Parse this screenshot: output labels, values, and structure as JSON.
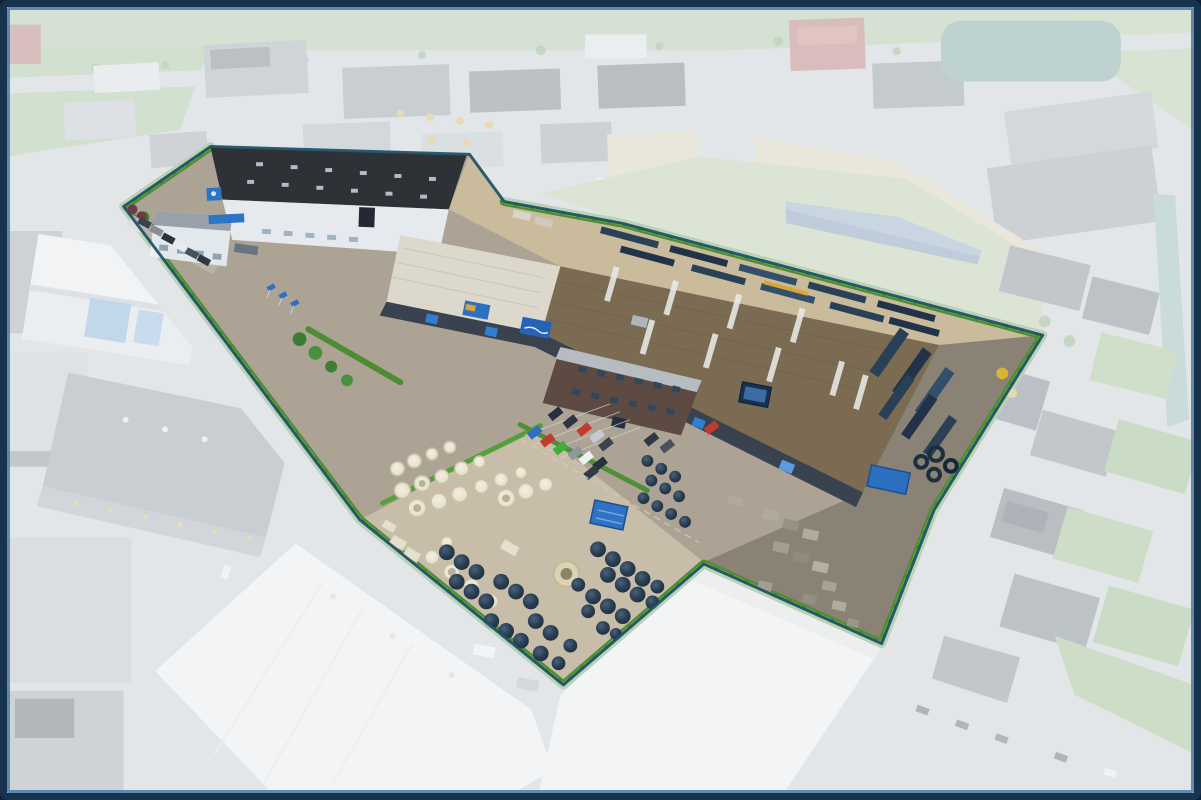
{
  "image": {
    "kind": "aerial-drone-photograph",
    "subject": "industrial company premises highlighted in full color against faded surroundings",
    "width_px": 1201,
    "height_px": 800
  },
  "frame": {
    "outer_color": "#17334e",
    "accent_color": "#4a7aa3",
    "outer_width_px": 7,
    "accent_width_px": 3,
    "corner_radius_px": 8
  },
  "highlight": {
    "fade_overlay_color": "#f2f5f8",
    "fade_overlay_opacity": 0.66,
    "boundary_line_color": "#1d5066",
    "boundary_hedge_color": "#4e8c33",
    "boundary_hedge_accent": "#63a93e"
  },
  "palette": {
    "road": "#c7cbce",
    "asphalt": "#aca394",
    "yard_concrete": "#c8bda8",
    "dark_asphalt": "#8a8375",
    "north_pipes_ground": "#c9bb9c",
    "grass": "#9fbe8c",
    "hedge_green": "#4e8c33",
    "skylight": "#e9ebe8",
    "door_blue": "#2f7fd0",
    "sign_blue": "#2e74c4",
    "container_blue": "#2b6fc0",
    "concrete_product": "#ece7d6",
    "tank_navy": "#253748",
    "pipe_navy": "#2a4056",
    "car_red": "#c23b2f",
    "car_blue": "#2f6fc3",
    "car_green": "#3fae3a",
    "car_white": "#eef0f2",
    "car_dark": "#27313d",
    "car_gray": "#8f979e",
    "faded_building_white": "#f3f3f1",
    "faded_roof_dark": "#565d66",
    "faded_roof_red": "#aa544a",
    "faded_roof_teal": "#5d8f8b",
    "faded_roof_blue": "#5d7fa6",
    "water_teal": "#7fae9e",
    "sand": "#d9c9a4"
  },
  "scene": {
    "property": {
      "buildings": [
        {
          "name": "north-warehouse",
          "roof_color": "#2e3237",
          "wall_color": "#e6eaee",
          "signage": [
            "blue-roof-sign",
            "blue-wall-logo"
          ]
        },
        {
          "name": "main-warehouse",
          "roof_color": "#7b6b53",
          "west_hall_roof_color": "#dcd8cb",
          "facade_color": "#39424e",
          "signage": [
            "facade-banners",
            "billboard-screen"
          ]
        },
        {
          "name": "office-building",
          "brick_color": "#5d4a42",
          "roof_color": "#b7bcc1"
        }
      ],
      "storage": [
        {
          "name": "concrete-products-yard",
          "item_color": "#ece7d6"
        },
        {
          "name": "plastic-tank-yard",
          "item_color": "#253748"
        },
        {
          "name": "pipe-storage-north",
          "item_color": "#2a4056"
        },
        {
          "name": "pipe-storage-east",
          "item_color": "#2a4056"
        },
        {
          "name": "concrete-block-yard",
          "item_color": "#a8a396"
        },
        {
          "name": "blue-container",
          "color": "#2b6fc0"
        },
        {
          "name": "blue-shed",
          "color": "#2f72c5"
        }
      ],
      "parking_car_colors": [
        "#c23b2f",
        "#2f6fc3",
        "#3fae3a",
        "#eef0f2",
        "#27313d",
        "#8f979e"
      ],
      "entrance_flag_color": "#2f6fc3"
    },
    "surroundings": {
      "areas": [
        "green-fields-north",
        "industrial-estate-north",
        "residential-houses-east",
        "canal-east",
        "white-warehouses-south",
        "roads",
        "parked-cars-south-west"
      ],
      "fade": "white translucent wash outside property boundary"
    }
  }
}
